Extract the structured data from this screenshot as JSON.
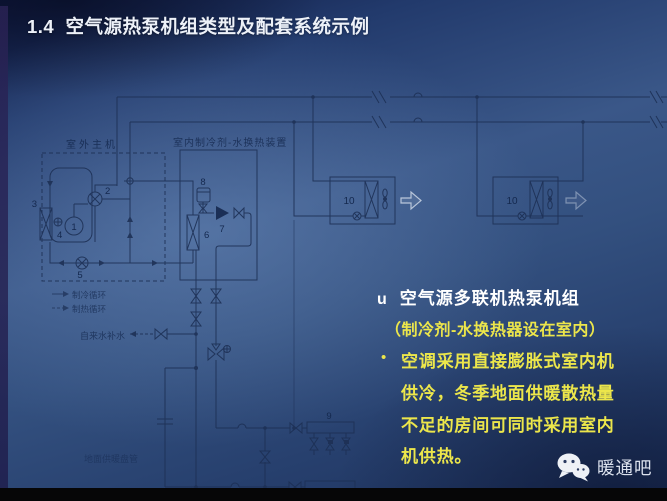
{
  "slide": {
    "title": "1.4  空气源热泵机组类型及配套系统示例",
    "watermark_label": "暖通吧"
  },
  "right_panel": {
    "marker": "u",
    "heading": "空气源多联机热泵机组",
    "subheading": "（制冷剂-水换热器设在室内）",
    "bullet_char": "•",
    "paragraph_lines": {
      "0": "空调采用直接膨胀式室内机",
      "1": "供冷，冬季地面供暖散热量",
      "2": "不足的房间可同时采用室内",
      "3": "机供热。"
    }
  },
  "diagram": {
    "outdoor_unit_label": "室外主机",
    "hydro_module_label": "室内制冷剂-水换热装置",
    "tap_water_label": "自来水补水",
    "floor_coil_label": "地面供暖盘管",
    "legend": [
      {
        "label": "制冷循环"
      },
      {
        "label": "制热循环"
      }
    ],
    "numbers": {
      "compressor": "1",
      "four_way_valve": "2",
      "outdoor_hx": "3",
      "outdoor_fan": "4",
      "throttle": "5",
      "plate_hx": "6",
      "pump": "7",
      "expansion_tank": "8",
      "manifold": "9",
      "indoor_unit_a": "10",
      "indoor_unit_b": "10"
    }
  },
  "colors": {
    "background_blue": "#3a5788",
    "title_text": "#edf1f8",
    "highlight_yellow": "#ece64b",
    "diagram_line": "#1d3055",
    "watermark_text": "#dce2ee",
    "footer_bar": "#060607"
  }
}
